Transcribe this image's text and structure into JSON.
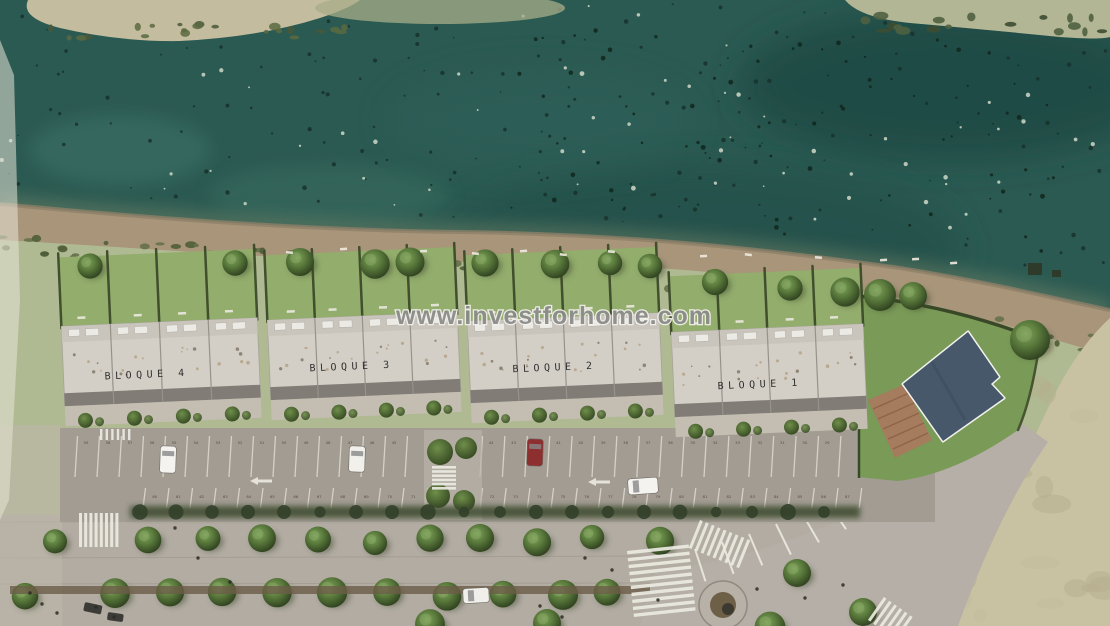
{
  "watermark": {
    "text": "www.investforhome.com",
    "color": "#8c8c8c"
  },
  "palette": {
    "water": "#2b5a52",
    "water_dark": "#1d4743",
    "water_light": "#41756a",
    "sand_spit": "#c4bc9e",
    "sandbar": "#b3b694",
    "sand_corner": "#c9c2a2",
    "land": "#b0ba92",
    "beach": "#a8957a",
    "beach_wet": "#8d7f68",
    "garden_grass": "#93ad6d",
    "lawn": "#7a9a58",
    "roof": "#d3cfc7",
    "roof_strip": "#c9c5bd",
    "roof_front": "#817d76",
    "roof_box": "#eceae4",
    "driveway": "#c4beb2",
    "asphalt": "#a29c93",
    "promenade": "#b2aca3",
    "curved_road": "#b5afa7",
    "hedge": "#394827",
    "tree_hi": "#7da35b",
    "tree_mid": "#5a7a3c",
    "tree_dark": "#2c3d1d",
    "pool": "#47586b",
    "pool_deck": "#f2f2ee",
    "terracotta": "#a87a5e",
    "planter": "#6b5d47",
    "marking_white": "#eceae2",
    "red_car": "#8e2f2f",
    "white_car": "#f4f3ef"
  },
  "blocks": [
    {
      "label": "BLOQUE 4",
      "x": 63,
      "w": 196,
      "roofY": 322,
      "roofH": 80,
      "gardenY": 253,
      "units": 4,
      "labelX": 104,
      "labelY": 377,
      "rot": -2.5
    },
    {
      "label": "BLOQUE 3",
      "x": 269,
      "w": 190,
      "roofY": 316,
      "roofH": 80,
      "gardenY": 251,
      "units": 4,
      "labelX": 309,
      "labelY": 369,
      "rot": -2.5
    },
    {
      "label": "BLOQUE 2",
      "x": 469,
      "w": 192,
      "roofY": 317,
      "roofH": 82,
      "gardenY": 251,
      "units": 4,
      "labelX": 512,
      "labelY": 370,
      "rot": -2.5
    },
    {
      "label": "BLOQUE 1",
      "x": 673,
      "w": 192,
      "roofY": 328,
      "roofH": 85,
      "gardenY": 272,
      "units": 4,
      "labelX": 717,
      "labelY": 387,
      "rot": -2.5
    }
  ],
  "garden_trees": [
    [
      90,
      266
    ],
    [
      235,
      263
    ],
    [
      300,
      262
    ],
    [
      375,
      264
    ],
    [
      410,
      262
    ],
    [
      485,
      263
    ],
    [
      555,
      264
    ],
    [
      610,
      263
    ],
    [
      650,
      266
    ],
    [
      715,
      282
    ],
    [
      790,
      288
    ],
    [
      845,
      292
    ]
  ],
  "lawn_trees": [
    [
      880,
      295,
      16
    ],
    [
      913,
      296,
      14
    ],
    [
      1030,
      340,
      20
    ]
  ],
  "parking": {
    "x": 60,
    "y": 428,
    "w": 875,
    "h": 94,
    "top_lines_a": {
      "x0": 75,
      "step": 22.0,
      "n": 16,
      "y1": 436,
      "y2": 477
    },
    "top_lines_b": {
      "x0": 480,
      "step": 22.4,
      "n": 17,
      "y1": 436,
      "y2": 477
    },
    "bottom_lines_a": {
      "x0": 143,
      "step": 23.5,
      "n": 13,
      "y1": 488,
      "y2": 508
    },
    "bottom_lines_b": {
      "x0": 480,
      "step": 23.7,
      "n": 17,
      "y1": 488,
      "y2": 508
    },
    "top_row_numbers_a": [
      59,
      58,
      57,
      56,
      55,
      54,
      53,
      52,
      51,
      50,
      49,
      48,
      47,
      46,
      45
    ],
    "top_row_numbers_b": [
      44,
      43,
      42,
      41,
      40,
      39,
      38,
      37,
      36,
      35,
      34,
      33,
      32,
      31,
      30,
      29
    ],
    "bottom_row_numbers_a": [
      60,
      61,
      62,
      63,
      64,
      65,
      66,
      67,
      68,
      69,
      70,
      71
    ],
    "bottom_row_numbers_b": [
      72,
      73,
      74,
      75,
      76,
      77,
      78,
      79,
      80,
      81,
      82,
      83,
      84,
      85,
      86,
      87
    ],
    "arrows": [
      [
        250,
        481
      ],
      [
        588,
        482
      ]
    ],
    "island_bushes": [
      [
        440,
        452,
        13
      ],
      [
        466,
        448,
        11
      ],
      [
        438,
        496,
        12
      ],
      [
        464,
        501,
        11
      ]
    ],
    "hedge_band": {
      "x": 130,
      "y": 506,
      "w": 730,
      "h": 12
    }
  },
  "cars": [
    {
      "name": "white-car-1",
      "x": 160,
      "y": 446,
      "w": 16,
      "h": 27,
      "color": "#f4f3ef",
      "rot": 2
    },
    {
      "name": "white-car-2",
      "x": 349,
      "y": 446,
      "w": 16,
      "h": 26,
      "color": "#f1f0eb",
      "rot": 2
    },
    {
      "name": "red-car",
      "x": 527,
      "y": 439,
      "w": 16,
      "h": 27,
      "color": "#8e2f2f",
      "rot": 2
    },
    {
      "name": "white-car-road",
      "x": 628,
      "y": 478,
      "w": 30,
      "h": 16,
      "color": "#f4f3ef",
      "rot": -4
    },
    {
      "name": "white-van-promenade",
      "x": 463,
      "y": 588,
      "w": 26,
      "h": 15,
      "color": "#f0efe9",
      "rot": -3
    }
  ],
  "dark_vehicles": [
    [
      85,
      602,
      18,
      9,
      12
    ],
    [
      108,
      612,
      16,
      8,
      8
    ]
  ],
  "crosswalks": [
    {
      "x": 79,
      "y": 513,
      "rot": 0,
      "bars": 8,
      "barW": 3,
      "barH": 34,
      "gap": 2.2
    },
    {
      "x": 432,
      "y": 466,
      "rot": 0,
      "bars": 6,
      "barW": 24,
      "barH": 2.6,
      "gap": 1.6
    },
    {
      "x": 627,
      "y": 551,
      "rot": -6,
      "bars": 10,
      "barW": 62,
      "barH": 3.4,
      "gap": 3.6
    },
    {
      "x": 700,
      "y": 520,
      "rot": 22,
      "bars": 9,
      "barW": 3,
      "barH": 30,
      "gap": 3.4
    },
    {
      "x": 884,
      "y": 597,
      "rot": 35,
      "bars": 6,
      "barW": 3,
      "barH": 28,
      "gap": 3.4
    },
    {
      "x": 100,
      "y": 429,
      "rot": 0,
      "bars": 6,
      "barW": 2.4,
      "barH": 11,
      "gap": 3.2
    }
  ],
  "promenade": {
    "row1_y": 540,
    "row1_x": [
      55,
      148,
      208,
      262,
      318,
      375,
      430,
      480,
      537,
      592,
      660
    ],
    "row2_y": 594,
    "row2_x": [
      25,
      115,
      170,
      222,
      277,
      332,
      387,
      447,
      503,
      563,
      607
    ],
    "row3": [
      [
        430,
        624
      ],
      [
        547,
        623
      ],
      [
        770,
        627
      ]
    ],
    "curve_trees": [
      [
        797,
        573
      ],
      [
        863,
        612
      ]
    ],
    "planter": {
      "x": 10,
      "y": 586,
      "w": 640,
      "h": 8
    },
    "roundabout": {
      "cx": 723,
      "cy": 605,
      "r": 24
    }
  },
  "people": [
    [
      175,
      528
    ],
    [
      198,
      558
    ],
    [
      30,
      593
    ],
    [
      42,
      604
    ],
    [
      57,
      613
    ],
    [
      96,
      607
    ],
    [
      114,
      617
    ],
    [
      230,
      582
    ],
    [
      540,
      606
    ],
    [
      562,
      617
    ],
    [
      585,
      558
    ],
    [
      612,
      570
    ],
    [
      658,
      600
    ],
    [
      757,
      589
    ],
    [
      805,
      598
    ],
    [
      843,
      585
    ]
  ],
  "beach_structures": [
    [
      1028,
      263,
      14,
      12
    ],
    [
      1052,
      270,
      9,
      7
    ]
  ],
  "sunbeds": [
    [
      286,
      251
    ],
    [
      340,
      248
    ],
    [
      420,
      250
    ],
    [
      472,
      252
    ],
    [
      520,
      250
    ],
    [
      560,
      253
    ],
    [
      608,
      250
    ],
    [
      700,
      255
    ],
    [
      745,
      253
    ],
    [
      815,
      256
    ],
    [
      880,
      259
    ],
    [
      912,
      258
    ],
    [
      950,
      262
    ]
  ],
  "fan_stripes": [
    [
      695,
      549,
      72
    ],
    [
      722,
      542,
      70
    ],
    [
      749,
      534,
      67
    ],
    [
      776,
      524,
      64
    ],
    [
      802,
      513,
      60
    ],
    [
      827,
      501,
      56
    ],
    [
      851,
      488,
      52
    ],
    [
      874,
      474,
      48
    ],
    [
      896,
      459,
      45
    ],
    [
      917,
      443,
      42
    ],
    [
      937,
      427,
      40
    ]
  ]
}
